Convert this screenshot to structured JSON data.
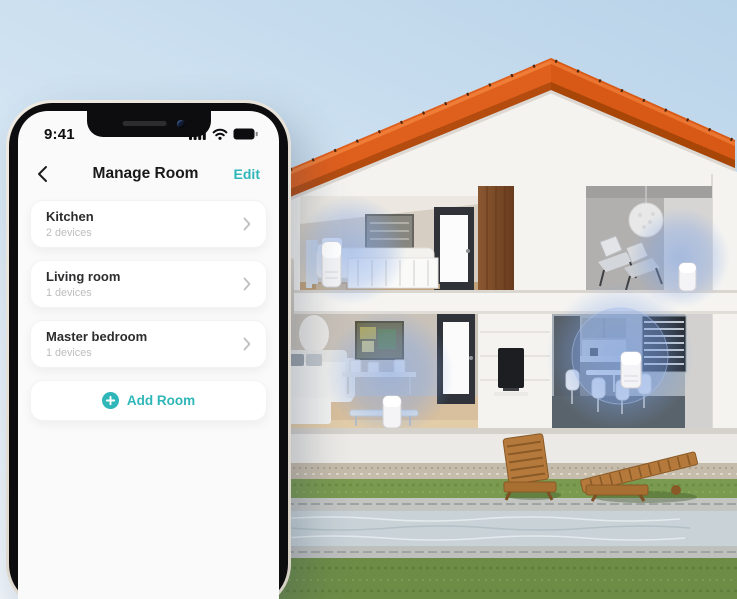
{
  "colors": {
    "accent_teal": "#2fb6b9",
    "roof_orange": "#df5f1d",
    "device_glow_blue": "#7ea4e8",
    "sky_blue": "#bcd5ea"
  },
  "phone": {
    "status_bar": {
      "time": "9:41",
      "icons": [
        "cellular-signal-icon",
        "wifi-icon",
        "battery-icon"
      ]
    },
    "header": {
      "back_icon": "chevron-left-icon",
      "title": "Manage Room",
      "edit_label": "Edit"
    },
    "room_list": [
      {
        "name": "Kitchen",
        "device_count": "2 devices"
      },
      {
        "name": "Living room",
        "device_count": "1 devices"
      },
      {
        "name": "Master bedroom",
        "device_count": "1 devices"
      }
    ],
    "add_room": {
      "icon": "plus-circle-icon",
      "label": "Add Room"
    }
  },
  "scene": {
    "smart_speaker_highlights": 4
  }
}
